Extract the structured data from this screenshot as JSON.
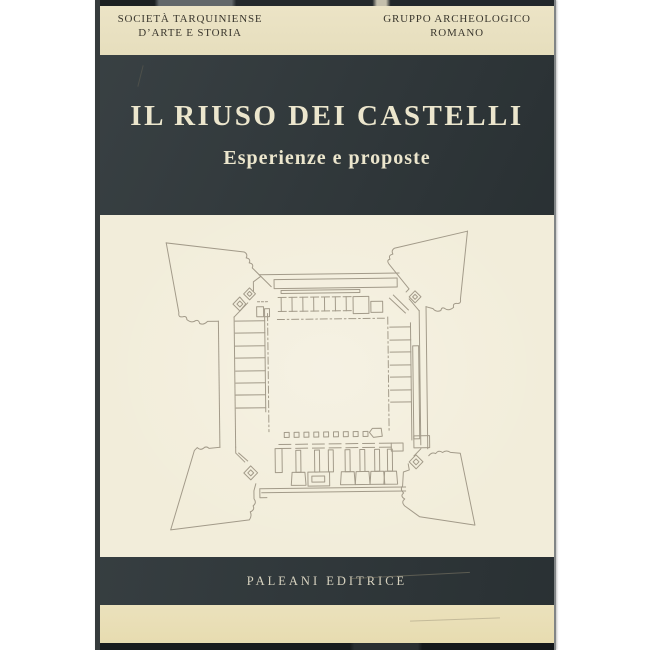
{
  "cover": {
    "header": {
      "left": {
        "line1": "SOCIETÀ TARQUINIENSE",
        "line2": "D’ARTE E STORIA"
      },
      "right": {
        "line1": "GRUPPO ARCHEOLOGICO",
        "line2": "ROMANO"
      }
    },
    "title": "IL RIUSO DEI CASTELLI",
    "subtitle": "Esperienze e proposte",
    "publisher": "PALEANI EDITRICE",
    "illustration": "fortress-floor-plan-line-drawing"
  },
  "colors": {
    "scan_background": "#ffffff",
    "cover_dark": "#2e3639",
    "band_cream": "#eae2c3",
    "plan_panel_cream": "#f2edda",
    "bottom_band_cream": "#e9dfb6",
    "title_text": "#ece6cd",
    "header_text": "#3a372e",
    "publisher_text": "#d8d3c0",
    "plan_line": "#a29a89"
  }
}
